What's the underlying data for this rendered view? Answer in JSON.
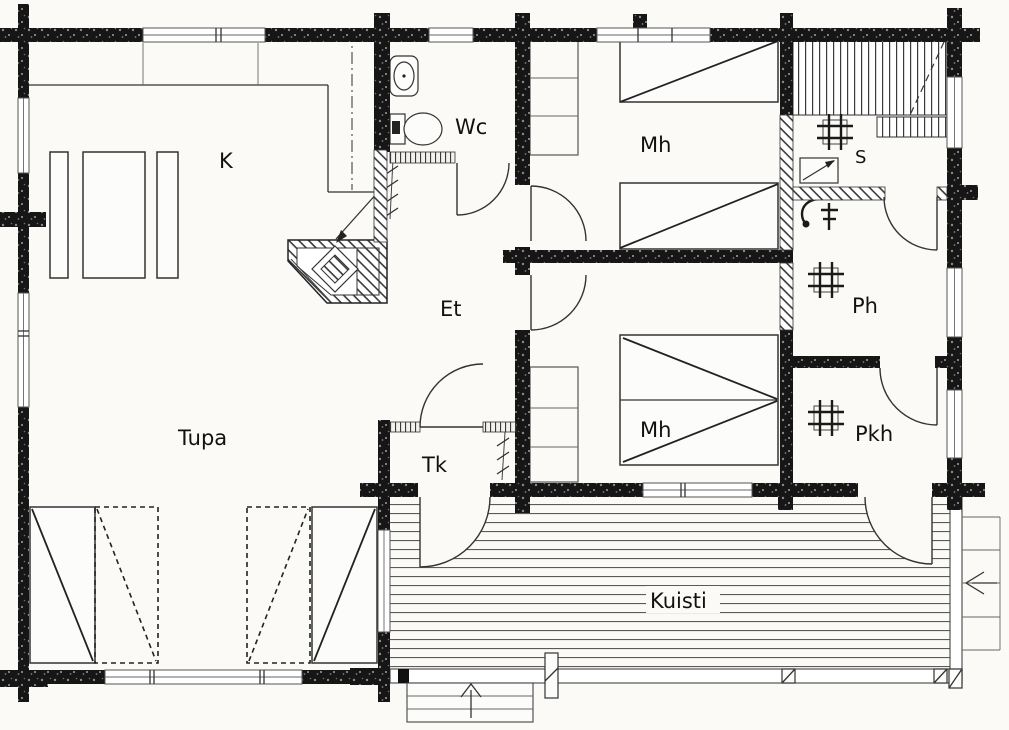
{
  "document": {
    "type": "architectural-floor-plan",
    "style": "log-house / cottage plan, black log walls, Finnish room abbreviations"
  },
  "colors": {
    "background": "#fbfaf6",
    "wall": "#161616",
    "line": "#333333",
    "paper": "#ffffff"
  },
  "rooms": {
    "kitchen": {
      "label": "K"
    },
    "living_room": {
      "label": "Tupa"
    },
    "toilet": {
      "label": "Wc"
    },
    "hallway": {
      "label": "Et"
    },
    "bedroom_top": {
      "label": "Mh"
    },
    "bedroom_middle": {
      "label": "Mh"
    },
    "sauna": {
      "label": "S"
    },
    "washroom": {
      "label": "Ph"
    },
    "dressing_room": {
      "label": "Pkh"
    },
    "vestibule": {
      "label": "Tk"
    },
    "porch": {
      "label": "Kuisti"
    }
  },
  "symbols": {
    "floor_drain": "grid-symbol in S, Ph and Pkh",
    "shower": "hooked-arm shower with mixer tap in Ph",
    "sauna_stove": "rectangle with diagonal arrow in S",
    "sauna_benches": "striped plank benches in S",
    "fireplace": "hatched corner fireplace with diamond firebox and flue arrow",
    "coat_rack": "slash-tick rack in Et and Tk",
    "beds": "rectangles with diagonals (2 singles + 1 double + 2 fold-out sofas)",
    "steps_arrows": "up arrow on front steps, left arrow on side steps"
  }
}
